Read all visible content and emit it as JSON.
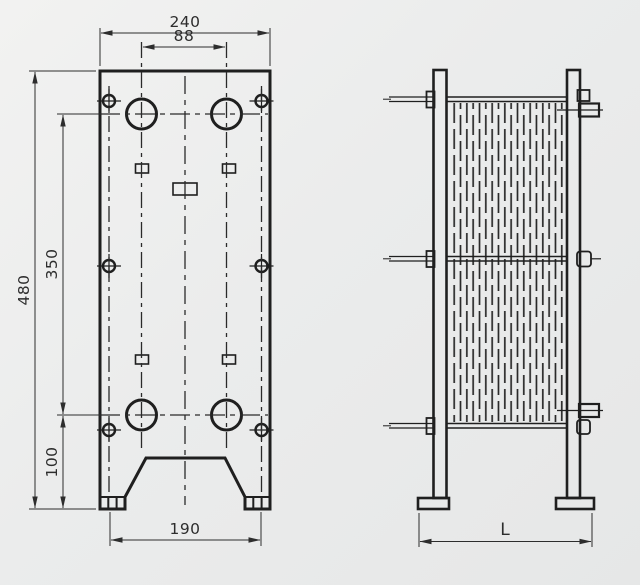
{
  "front_view": {
    "dim_width": "240",
    "dim_port_span": "88",
    "dim_height": "480",
    "dim_port_vertical": "350",
    "dim_bottom": "100",
    "dim_feet": "190"
  },
  "side_view": {
    "dim_length": "L"
  },
  "colors": {
    "background": "#eceded",
    "line": "#1f1f1f",
    "dim": "#333333"
  }
}
